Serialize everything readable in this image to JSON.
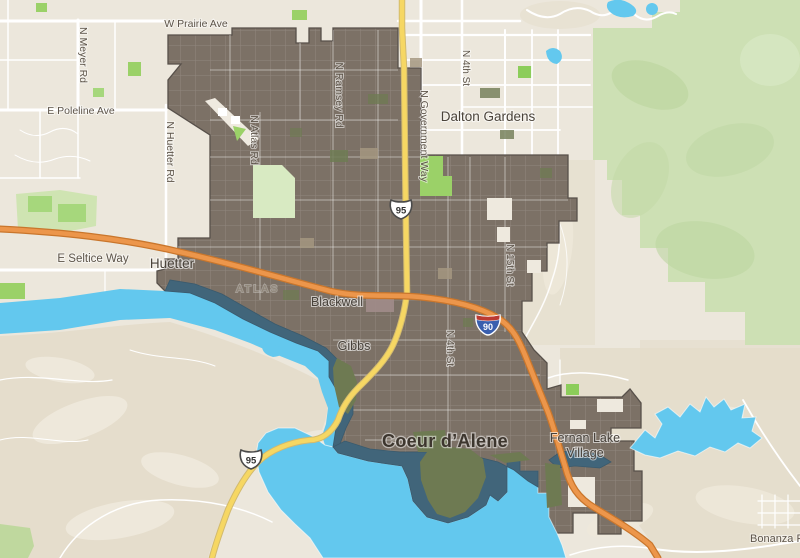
{
  "map": {
    "city": {
      "label": "Coeur d’Alene"
    },
    "towns": {
      "dalton_gardens": "Dalton Gardens",
      "huetter": "Huetter",
      "fernan_line1": "Fernan Lake",
      "fernan_line2": "Village"
    },
    "neighborhoods": {
      "atlas": "ATLAS",
      "blackwell": "Blackwell",
      "gibbs": "Gibbs"
    },
    "roads": {
      "w_prairie_ave": "W Prairie Ave",
      "n_meyer_rd": "N Meyer Rd",
      "e_poleline_ave": "E Poleline Ave",
      "n_huetter_rd": "N Huetter Rd",
      "n_atlas_rd": "N Atlas Rd",
      "n_ramsey_rd": "N Ramsey Rd",
      "n_government_way": "N Government Way",
      "n_4th_st_north": "N 4th St",
      "n_4th_st_south": "N 4th St",
      "n_15th_st": "N 15th St",
      "e_seltice_way": "E Seltice Way",
      "bonanza_rd": "Bonanza R"
    },
    "highway_shields": {
      "us95": "95",
      "i90": "90"
    },
    "colors": {
      "land": "#ece7dc",
      "terrain_shade": "#e3dbc8",
      "forest": "#cde0b4",
      "water": "#63c8ee",
      "city_water": "#41657a",
      "city_fill": "#7c7166",
      "interstate_orange": "#ec964b",
      "us_highway_yellow": "#f6d763",
      "park_green": "#9bd168",
      "label_dark": "#4c443b"
    }
  }
}
